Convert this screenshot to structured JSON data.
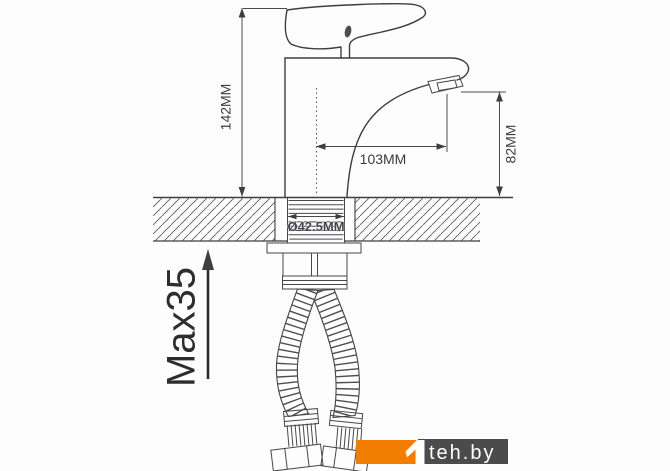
{
  "labels": {
    "height": "142MM",
    "spout_reach": "103MM",
    "spout_height": "82MM",
    "hole_diameter": "Ø42.5MM",
    "max_thickness": "Max35"
  },
  "watermark": {
    "brand": "teh.by"
  },
  "colors": {
    "logo_orange": "#F27D00",
    "logo_gray": "#4B4B4B",
    "logo_text": "#FFFFFF",
    "line": "#3E3E3E"
  }
}
